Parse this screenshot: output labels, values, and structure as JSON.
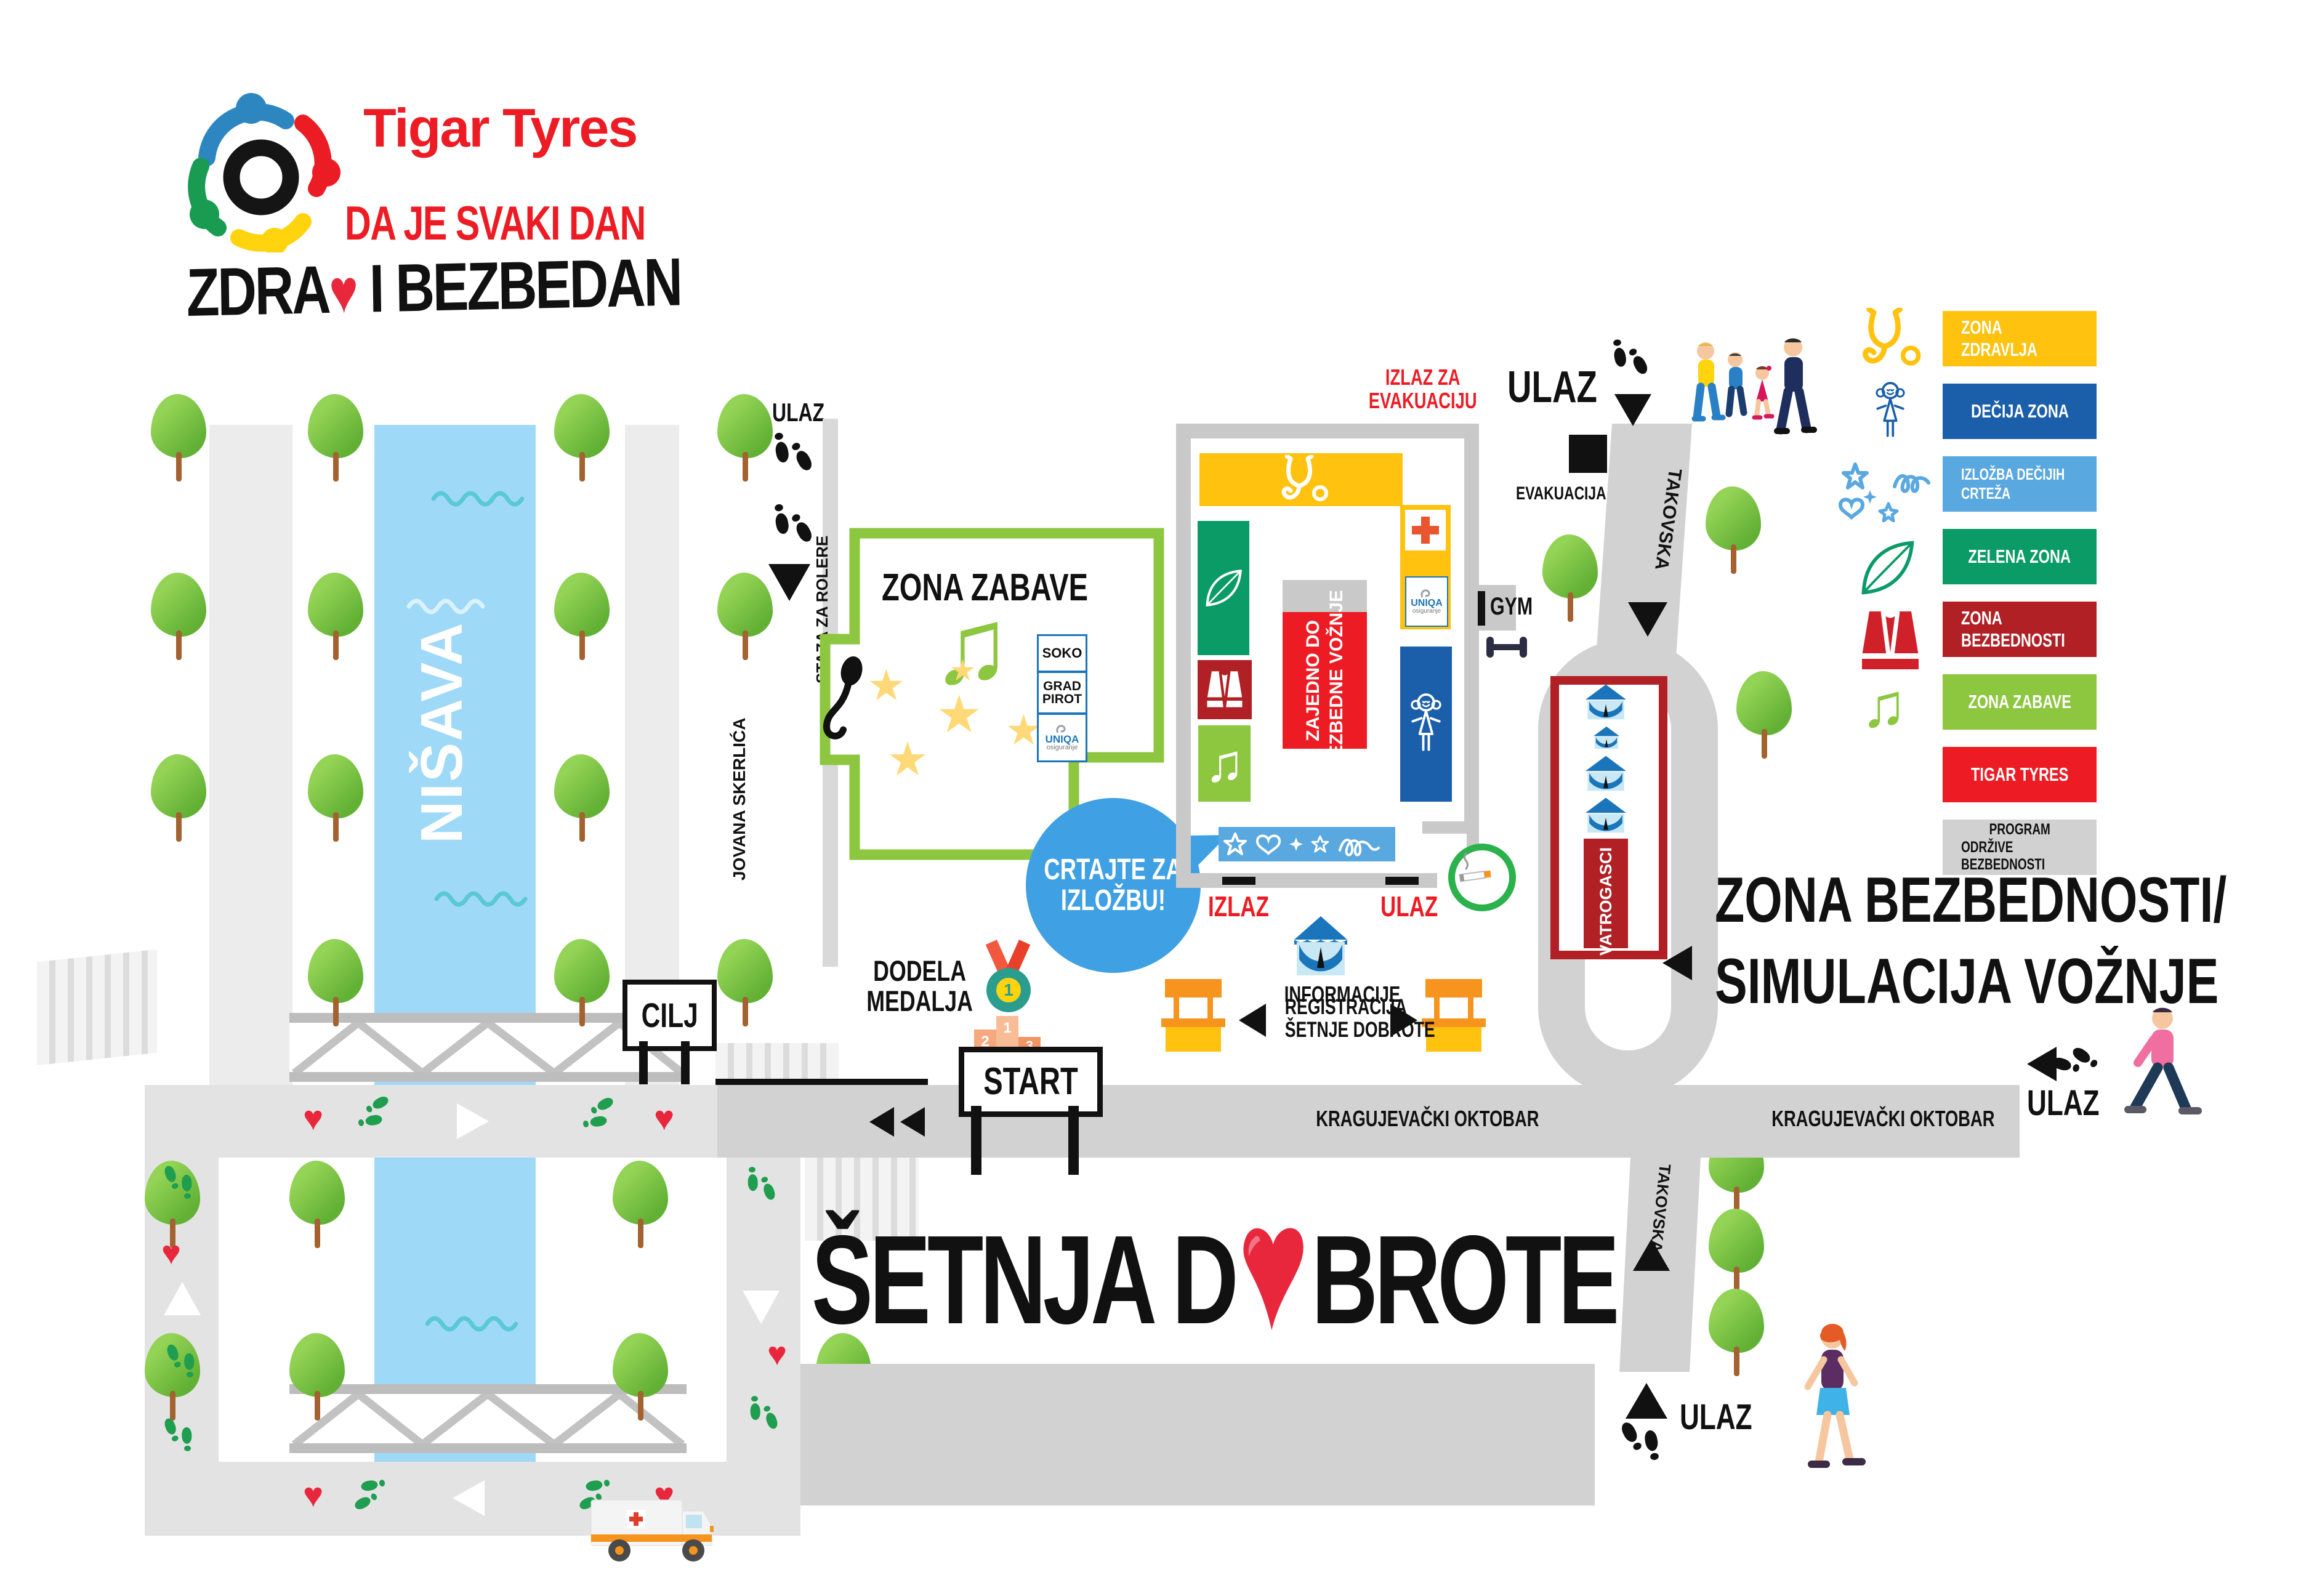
{
  "branding": {
    "company": "Tigar Tyres",
    "tagline_line1": "DA JE SVAKI DAN",
    "tagline_line2_start": "ZDRA",
    "tagline_line2_end": " I BEZBEDAN"
  },
  "event_title": {
    "part1": "ŠETNJA D",
    "part2": "BROTE"
  },
  "icons": {
    "heart": "♥",
    "star": "★",
    "music_note": "♫"
  },
  "legend": {
    "items": [
      {
        "label": "ZONA ZDRAVLJA",
        "color": "#FFC20E",
        "icon": "stethoscope-icon"
      },
      {
        "label": "DEČIJA ZONA",
        "color": "#1B5FAA",
        "icon": "girl-doodle-icon"
      },
      {
        "label": "IZLOŽBA DEČIJIH CRTEŽA",
        "color": "#5AA8E0",
        "icon": "doodles-icon"
      },
      {
        "label": "ZELENA ZONA",
        "color": "#0A9B66",
        "icon": "leaf-icon"
      },
      {
        "label": "ZONA BEZBEDNOSTI",
        "color": "#B02025",
        "icon": "safety-vest-icon"
      },
      {
        "label": "ZONA ZABAVE",
        "color": "#8DC63F",
        "icon": "music-note-icon"
      },
      {
        "label": "TIGAR TYRES",
        "color": "#ED1C24",
        "icon": null
      },
      {
        "label_line1": "PROGRAM",
        "label_line2": "ODRŽIVE BEZBEDNOSTI",
        "color": "#D1D1D1",
        "icon": null
      }
    ]
  },
  "map": {
    "river_name": "NIŠAVA",
    "streets": {
      "kragujevacki": "KRAGUJEVAČKI OKTOBAR",
      "takovska": "TAKOVSKA",
      "jovana": "JOVANA SKERLIĆA",
      "rolere": "STAZA ZA ROLERE"
    },
    "signs": {
      "start": "START",
      "cilj": "CILJ"
    },
    "labels": {
      "ulaz": "ULAZ",
      "izlaz": "IZLAZ",
      "evakuacija": "EVAKUACIJA",
      "izlaz_evak_1": "IZLAZ ZA",
      "izlaz_evak_2": "EVAKUACIJU",
      "informacije": "INFORMACIJE",
      "gym": "GYM",
      "vatrogasci": "VATROGASCI",
      "dodela_1": "DODELA",
      "dodela_2": "MEDALJA",
      "reg_1": "REGISTRACIJA",
      "reg_2": "ŠETNJE DOBROTE",
      "bubble_1": "CRTAJTE ZA",
      "bubble_2": "IZLOŽBU!",
      "zabave_title": "ZONA ZABAVE",
      "banner_1": "ZAJEDNO DO",
      "banner_2": "BEZBEDNE VOŽNJE",
      "safety_1": "ZONA BEZBEDNOSTI/",
      "safety_2": "SIMULACIJA VOŽNJE"
    },
    "sponsors": {
      "soko": "SOKO",
      "grad_pirot_1": "GRAD",
      "grad_pirot_2": "PIROT",
      "uniqa_name": "UNIQA",
      "uniqa_sub": "osiguranje"
    },
    "podium": {
      "first": "1",
      "second": "2",
      "third": "3"
    },
    "medal": "1"
  },
  "colors": {
    "road": "#D2D2D2",
    "river": "#9FD9F8",
    "building_wall": "#C9C9C9",
    "bubble": "#3FA0E3",
    "heart": "#E8273D",
    "footprints_green": "#1E9E4E",
    "banner_red": "#ED1C24",
    "vatrogasci_red": "#B02025",
    "smoking_green": "#2BB24C"
  }
}
